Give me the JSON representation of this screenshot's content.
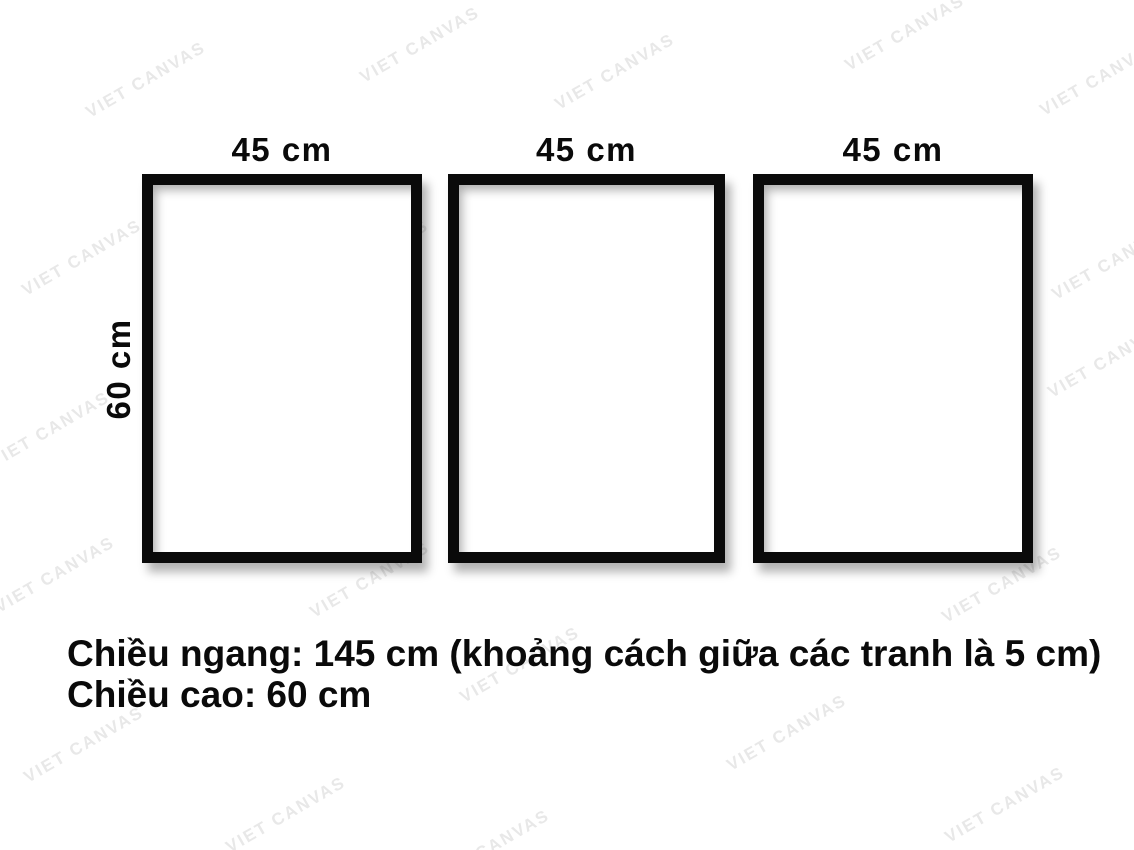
{
  "page": {
    "background_color": "#ffffff",
    "frame_border_color": "#0a0a0a"
  },
  "watermark": {
    "text": "VIET CANVAS",
    "color": "#e8e8e8"
  },
  "frames": [
    {
      "width_label": "45 cm"
    },
    {
      "width_label": "45 cm"
    },
    {
      "width_label": "45 cm"
    }
  ],
  "height_label": "60 cm",
  "caption": {
    "line1": "Chiều ngang: 145 cm (khoảng cách giữa các tranh là 5 cm)",
    "line2": "Chiều cao: 60 cm"
  }
}
